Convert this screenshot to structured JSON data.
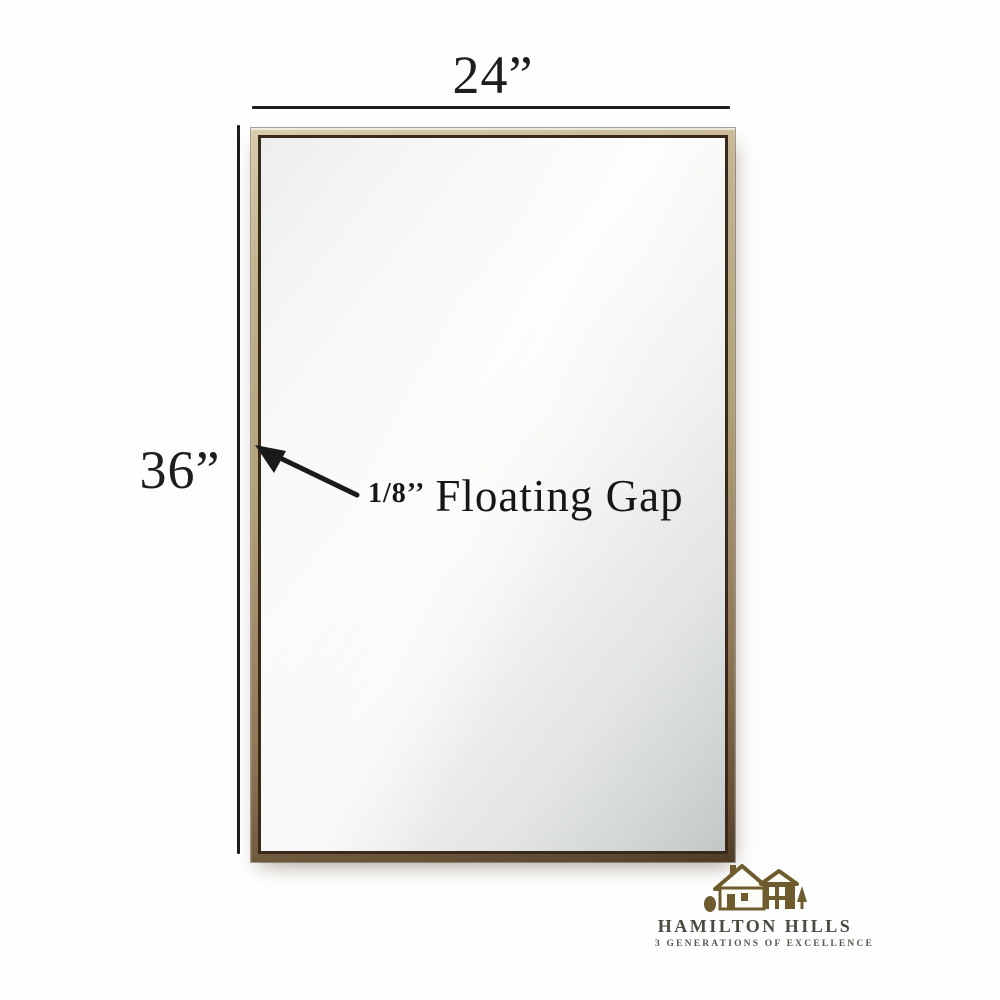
{
  "product": {
    "name": "framed-rectangular-mirror",
    "frame_colors": {
      "gold_light": "#d9ccad",
      "gold": "#b2a07a",
      "gold_dark": "#5e4830",
      "inner_edge": "#39291b"
    },
    "glass_colors": {
      "light": "#fbfbfa",
      "mid": "#e2e5e4",
      "dark": "#c3c7c7"
    }
  },
  "annotations": {
    "width_label": "24”",
    "height_label": "36”",
    "gap_size": "1/8’’",
    "gap_label": "Floating Gap",
    "line_color": "#1d1d1d"
  },
  "logo": {
    "brand": "HAMILTON HILLS",
    "tagline": "3 GENERATIONS OF EXCELLENCE",
    "icon": "house-icon",
    "icon_color": "#6f5c2e",
    "text_color": "#4b4a41"
  }
}
